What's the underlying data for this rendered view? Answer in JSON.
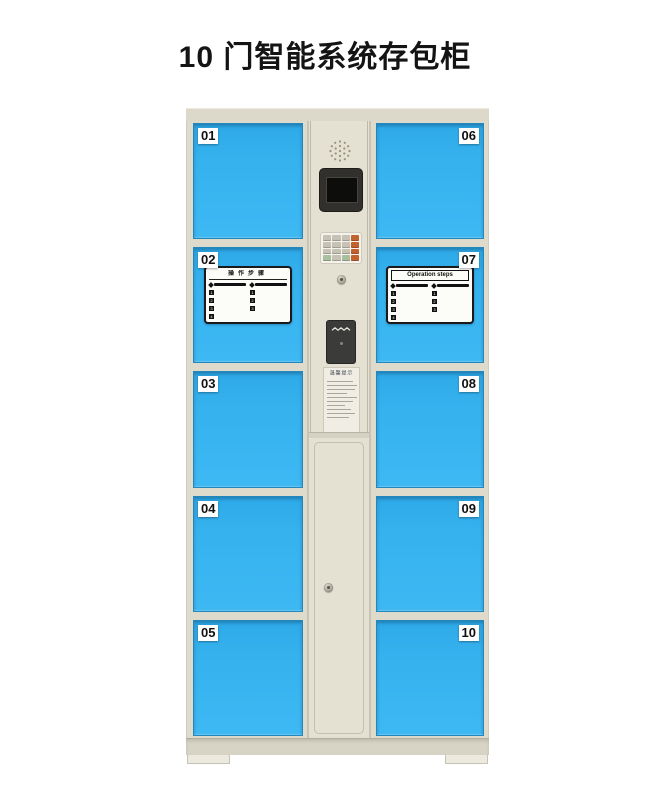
{
  "page": {
    "title": "10 门智能系统存包柜"
  },
  "colors": {
    "door_blue": "#35b2ee",
    "cabinet_beige": "#dfdbcc",
    "panel_beige": "#e4e0d2",
    "keypad_key_orange": "#c2622e",
    "screen_black": "#0d0d0c",
    "sticker_border_black": "#1a1a1a"
  },
  "locker": {
    "doors": [
      {
        "number": "01"
      },
      {
        "number": "02"
      },
      {
        "number": "03"
      },
      {
        "number": "04"
      },
      {
        "number": "05"
      },
      {
        "number": "06"
      },
      {
        "number": "07"
      },
      {
        "number": "08"
      },
      {
        "number": "09"
      },
      {
        "number": "10"
      }
    ]
  },
  "stickers": {
    "step_numbers": [
      "1",
      "2",
      "3",
      "4"
    ],
    "cn": {
      "title": "操作步骤"
    },
    "en": {
      "title": "Operation steps"
    },
    "notice": {
      "title": "温馨提示"
    }
  }
}
